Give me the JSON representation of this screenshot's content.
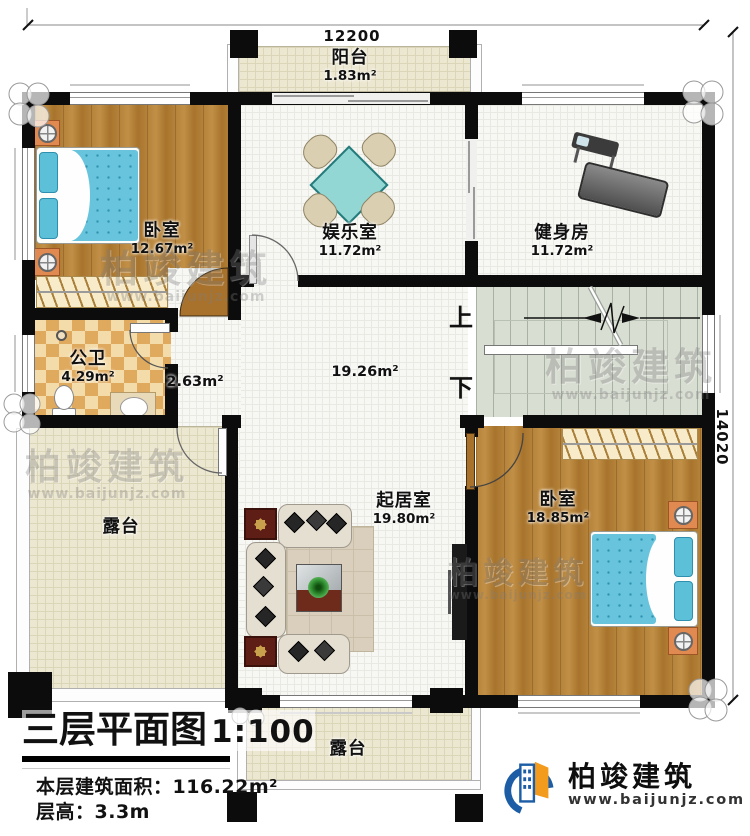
{
  "dimensions": {
    "width_mm": "12200",
    "height_mm": "14020"
  },
  "rooms": {
    "balcony": {
      "name": "阳台",
      "area": "1.83m²"
    },
    "bedroom1": {
      "name": "卧室",
      "area": "12.67m²"
    },
    "entertainment": {
      "name": "娱乐室",
      "area": "11.72m²"
    },
    "gym": {
      "name": "健身房",
      "area": "11.72m²"
    },
    "bathroom": {
      "name": "公卫",
      "area": "4.29m²"
    },
    "corridor": {
      "area": "2.63m²"
    },
    "hall": {
      "area": "19.26m²"
    },
    "living": {
      "name": "起居室",
      "area": "19.80m²"
    },
    "bedroom2": {
      "name": "卧室",
      "area": "18.85m²"
    },
    "terrace_left": {
      "name": "露台"
    },
    "terrace_bottom": {
      "name": "露台"
    }
  },
  "stairs": {
    "up_label": "上",
    "down_label": "下"
  },
  "title_block": {
    "title": "三层平面图",
    "scale": "1:100",
    "area_label": "本层建筑面积：",
    "area_value": "116.22m²",
    "floor_height_label": "层高：",
    "floor_height_value": "3.3m"
  },
  "brand": {
    "name": "柏竣建筑",
    "website": "www.baijunjz.com"
  },
  "watermark": {
    "text": "柏竣建筑",
    "url": "www.baijunjz.com"
  },
  "colors": {
    "wall": "#0c0c0c",
    "wood_floor": "#b5823a",
    "tile_floor": "#f7f7f4",
    "terrace_floor": "#ece7d1",
    "stairs_floor": "#d9ded3",
    "checker_dark": "#dfa95e",
    "bed_blue": "#68c4dc",
    "table_teal": "#93d7d5",
    "logo_blue": "#1d5da6",
    "logo_orange": "#f29b1d"
  }
}
